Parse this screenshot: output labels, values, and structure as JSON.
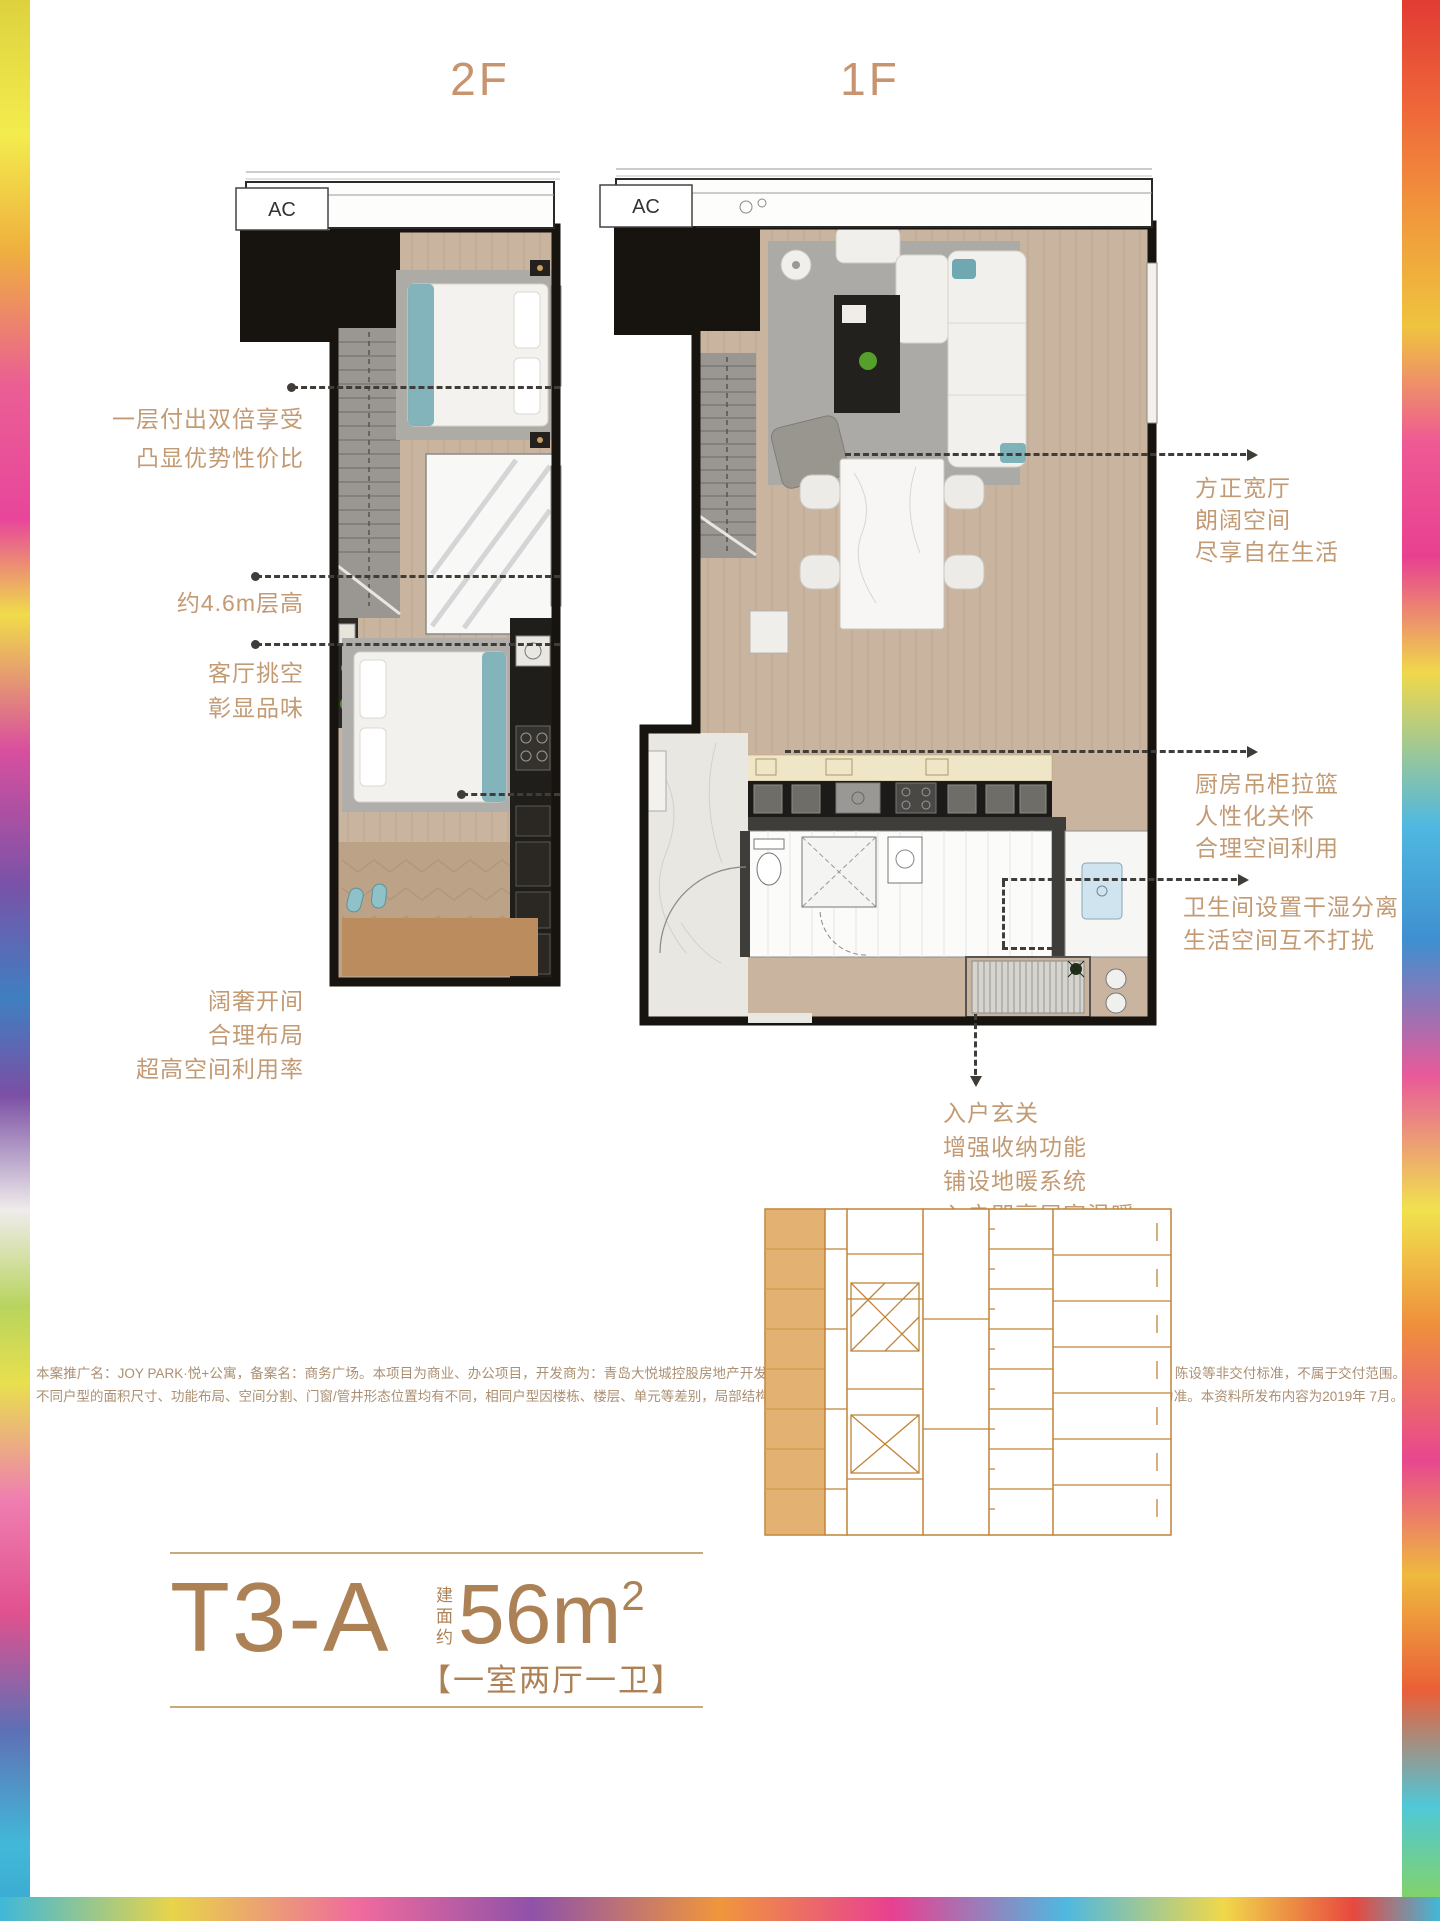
{
  "floor_labels": {
    "left": "2F",
    "right": "1F"
  },
  "ac_label": "AC",
  "annotations_left": [
    {
      "lines": [
        "一层付出双倍享受",
        "凸显优势性价比"
      ]
    },
    {
      "lines": [
        "约4.6m层高"
      ]
    },
    {
      "lines": [
        "客厅挑空",
        "彰显品味"
      ]
    },
    {
      "lines": [
        "阔奢开间",
        "合理布局",
        "超高空间利用率"
      ]
    }
  ],
  "annotations_right": [
    {
      "lines": [
        "方正宽厅",
        "朗阔空间",
        "尽享自在生活"
      ]
    },
    {
      "lines": [
        "厨房吊柜拉篮",
        "人性化关怀",
        "合理空间利用"
      ]
    },
    {
      "lines": [
        "卫生间设置干湿分离",
        "生活空间互不打扰"
      ]
    },
    {
      "lines": [
        "入户玄关",
        "增强收纳功能",
        "铺设地暖系统",
        "入户即享居家温暖"
      ]
    }
  ],
  "disclaimer": "本案推广名：JOY PARK·悦+公寓，备案名：商务广场。本项目为商业、办公项目，开发商为：青岛大悦城控股房地产开发有限公司。本宣传资料所涉及的户型仅供示意参考，其装修、家具、陈设等非交付标准，不属于交付范围。不同户型的面积尺寸、功能布局、空间分割、门窗/管井形态位置均有不同，相同户型因楼栋、楼层、单元等差别，局部结构、面积等也可能不同，最终以政府部门最终审定和图纸的销售合同为准。本资料所发布内容为2019年 7月。",
  "unit": {
    "code": "T3-A",
    "area_prefix": "建面约",
    "area_value": "56m",
    "area_sup": "2",
    "layout_tag": "【一室两厅一卫】"
  },
  "colors": {
    "bronze_title": "#c8946f",
    "bronze_unit": "#ad8156",
    "annotation": "#c29a73",
    "leader": "#403c38",
    "keyplan_stroke": "#c08438",
    "keyplan_fill": "#e3b272"
  }
}
